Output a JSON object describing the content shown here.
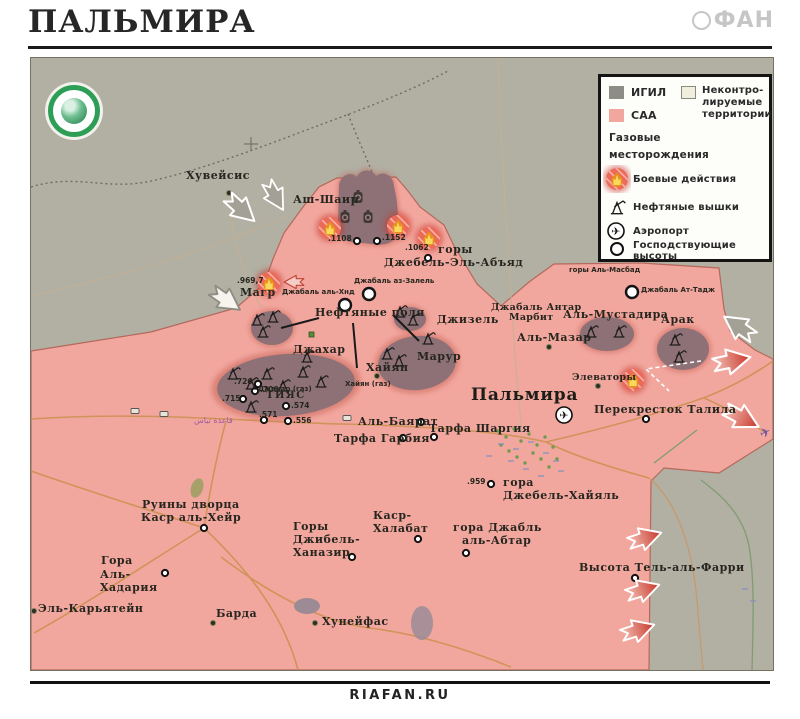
{
  "header": {
    "title": "ПАЛЬМИРА",
    "brand": "ФАН"
  },
  "footer": {
    "site": "RIAFAN.RU"
  },
  "colors": {
    "terrain_igil": "#b2afa3",
    "igil_swatch": "#8d8d85",
    "saa_pink": "#f2a79e",
    "uncontrolled": "#f1eedd",
    "combat_red": "#ec6a57",
    "field_blob": "#8d7176",
    "road_orange": "#cf9257"
  },
  "legend": {
    "igil": "ИГИЛ",
    "saa": "САА",
    "uncontrolled_lines": [
      "Неконтро-",
      "лируемые",
      "территории"
    ],
    "gas_line1": "Газовые",
    "gas_line2": "месторождения",
    "combat": "Боевые действия",
    "derricks": "Нефтяные вышки",
    "airport": "Аэропорт",
    "heights_line1": "Господствующие",
    "heights_line2": "высоты"
  },
  "map": {
    "labels": [
      {
        "t": "Хувейсис",
        "x": 185,
        "y": 169,
        "c": "pl",
        "n": "label-huweisis"
      },
      {
        "t": "Аш-Шаир",
        "x": 292,
        "y": 193,
        "c": "pl",
        "n": "label-ash-shair"
      },
      {
        "t": ".1108",
        "x": 327,
        "y": 234,
        "c": "num"
      },
      {
        "t": ".1152",
        "x": 381,
        "y": 233,
        "c": "num"
      },
      {
        "t": ".1062",
        "x": 404,
        "y": 243,
        "c": "num"
      },
      {
        "t": "горы",
        "x": 437,
        "y": 243,
        "c": "pl"
      },
      {
        "t": "Джебель-Эль-Абъяд",
        "x": 383,
        "y": 256,
        "c": "pl",
        "n": "label-jebel-el-abyad"
      },
      {
        "t": "Джабаль аз-Залель",
        "x": 353,
        "y": 277,
        "c": "sm"
      },
      {
        "t": "Джабаль аль-Хнд",
        "x": 281,
        "y": 288,
        "c": "sm"
      },
      {
        "t": ".969,7",
        "x": 236,
        "y": 276,
        "c": "num"
      },
      {
        "t": "Магр",
        "x": 239,
        "y": 286,
        "c": "pl",
        "n": "label-magr"
      },
      {
        "t": "Нефтяные поля",
        "x": 314,
        "y": 306,
        "c": "pl",
        "n": "label-oil-fields"
      },
      {
        "t": "Джизель",
        "x": 436,
        "y": 313,
        "c": "pl"
      },
      {
        "t": "Джахар",
        "x": 292,
        "y": 343,
        "c": "pl"
      },
      {
        "t": "Марур",
        "x": 416,
        "y": 350,
        "c": "pl"
      },
      {
        "t": "Хайян",
        "x": 365,
        "y": 361,
        "c": "pl"
      },
      {
        "t": "Хайян (газ)",
        "x": 344,
        "y": 380,
        "c": "sm"
      },
      {
        "t": "Джакар (газ)",
        "x": 257,
        "y": 385,
        "c": "sm"
      },
      {
        "t": ".726",
        "x": 233,
        "y": 377,
        "c": "num"
      },
      {
        "t": ".706",
        "x": 259,
        "y": 385,
        "c": "num"
      },
      {
        "t": "ТИЯС",
        "x": 265,
        "y": 390,
        "c": "caps",
        "n": "label-tiyas"
      },
      {
        "t": ".715",
        "x": 221,
        "y": 394,
        "c": "num"
      },
      {
        "t": ".574",
        "x": 290,
        "y": 401,
        "c": "num"
      },
      {
        "t": ".571",
        "x": 258,
        "y": 410,
        "c": "num"
      },
      {
        "t": ".556",
        "x": 292,
        "y": 416,
        "c": "num"
      },
      {
        "t": "قاعدة تياس",
        "x": 193,
        "y": 416,
        "c": "ar",
        "n": "label-tiyas-base-arabic"
      },
      {
        "t": "Аль-Баярат",
        "x": 357,
        "y": 415,
        "c": "pl"
      },
      {
        "t": "Тарфа Шаргия",
        "x": 428,
        "y": 422,
        "c": "pl"
      },
      {
        "t": "Тарфа Гарбия",
        "x": 333,
        "y": 432,
        "c": "pl"
      },
      {
        "t": "Пальмира",
        "x": 470,
        "y": 386,
        "c": "city",
        "n": "label-palmyra"
      },
      {
        "t": "Элеваторы",
        "x": 571,
        "y": 372,
        "c": "pl2"
      },
      {
        "t": "Перекресток Талила",
        "x": 593,
        "y": 403,
        "c": "pl"
      },
      {
        "t": "горы Аль-Масбад",
        "x": 568,
        "y": 266,
        "c": "sm"
      },
      {
        "t": "Джабаль Ат-Тадж",
        "x": 640,
        "y": 286,
        "c": "sm"
      },
      {
        "t": "Джабаль Антар",
        "x": 490,
        "y": 302,
        "c": "pl2"
      },
      {
        "t": "Марбит",
        "x": 508,
        "y": 312,
        "c": "pl2"
      },
      {
        "t": "Аль-Мустадира",
        "x": 562,
        "y": 308,
        "c": "pl"
      },
      {
        "t": "Арак",
        "x": 660,
        "y": 313,
        "c": "pl",
        "n": "label-arak"
      },
      {
        "t": "Аль-Мазар",
        "x": 516,
        "y": 331,
        "c": "pl"
      },
      {
        "t": ".959",
        "x": 466,
        "y": 477,
        "c": "num"
      },
      {
        "t": "гора",
        "x": 502,
        "y": 476,
        "c": "pl"
      },
      {
        "t": "Джебель-Хайяль",
        "x": 502,
        "y": 489,
        "c": "pl"
      },
      {
        "t": "гора Джабль",
        "x": 452,
        "y": 521,
        "c": "pl"
      },
      {
        "t": "аль-Абтар",
        "x": 461,
        "y": 534,
        "c": "pl"
      },
      {
        "t": "Каср-",
        "x": 372,
        "y": 509,
        "c": "pl"
      },
      {
        "t": "Халабат",
        "x": 372,
        "y": 522,
        "c": "pl"
      },
      {
        "t": "Горы",
        "x": 292,
        "y": 520,
        "c": "pl"
      },
      {
        "t": "Джибель-",
        "x": 292,
        "y": 533,
        "c": "pl"
      },
      {
        "t": "Ханазир",
        "x": 292,
        "y": 546,
        "c": "pl"
      },
      {
        "t": "Руины дворца",
        "x": 141,
        "y": 498,
        "c": "pl"
      },
      {
        "t": "Каср аль-Хейр",
        "x": 140,
        "y": 511,
        "c": "pl"
      },
      {
        "t": "Гора",
        "x": 100,
        "y": 554,
        "c": "pl"
      },
      {
        "t": "Аль-",
        "x": 99,
        "y": 568,
        "c": "pl"
      },
      {
        "t": "Хадария",
        "x": 99,
        "y": 581,
        "c": "pl"
      },
      {
        "t": "Эль-Карьятейн",
        "x": 37,
        "y": 602,
        "c": "pl",
        "n": "label-al-qaryatayn"
      },
      {
        "t": "Барда",
        "x": 215,
        "y": 607,
        "c": "pl"
      },
      {
        "t": "Хунейфас",
        "x": 321,
        "y": 615,
        "c": "pl"
      },
      {
        "t": "Высота Тель-аль-Фарри",
        "x": 578,
        "y": 561,
        "c": "pl",
        "n": "label-tel-al-farri"
      }
    ]
  }
}
